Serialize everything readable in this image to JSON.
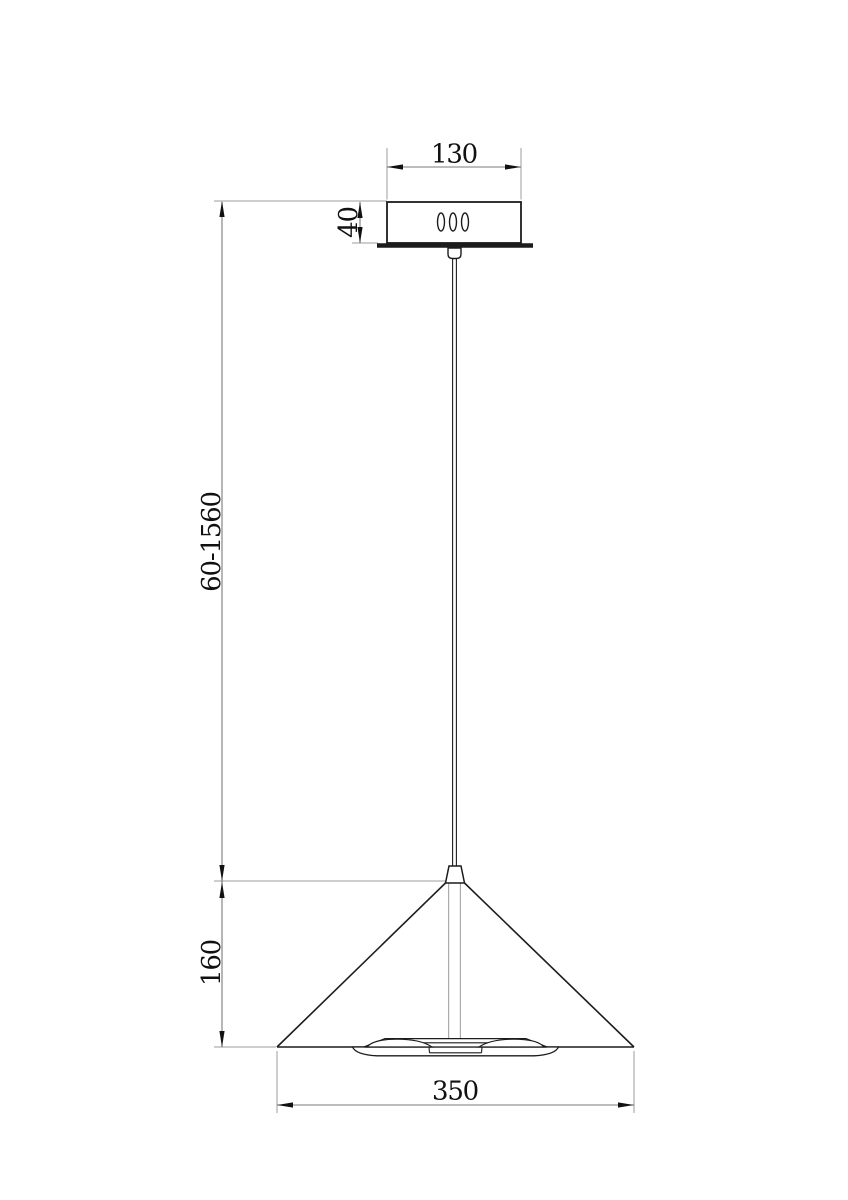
{
  "drawing": {
    "type": "pendant-lamp-dimension-drawing",
    "dimensions": {
      "canopy_width": "130",
      "canopy_height": "40",
      "suspension_length": "60-1560",
      "shade_height": "160",
      "shade_diameter": "350"
    },
    "colors": {
      "object_line": "#1c1c1c",
      "dimension_line": "#7a7a7a",
      "extension_line": "#9e9e9e",
      "text": "#111111",
      "background": "#ffffff"
    }
  }
}
